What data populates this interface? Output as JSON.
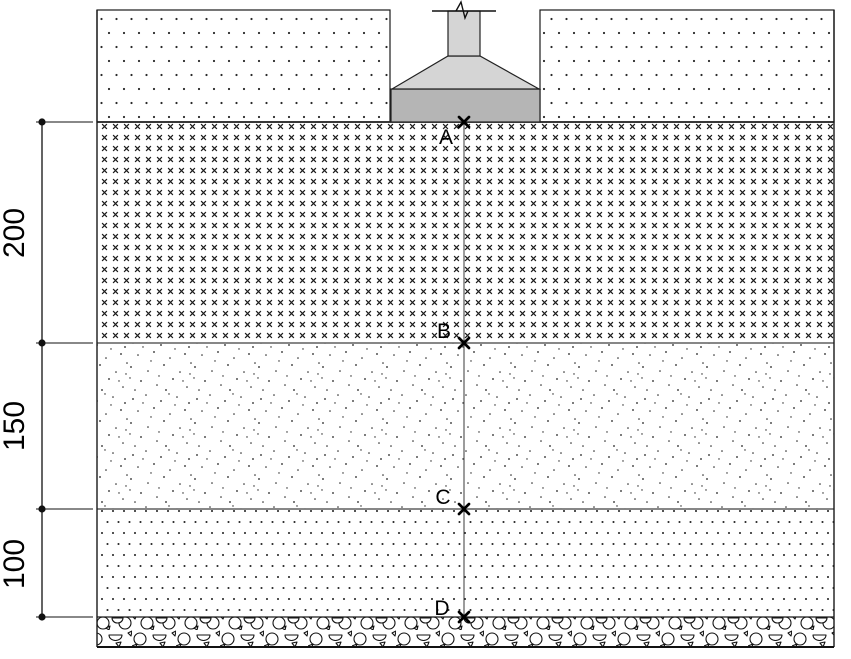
{
  "diagram": {
    "kind": "soil-profile-with-footing",
    "dimension_labels": [
      "200",
      "150",
      "100"
    ],
    "point_labels": [
      "A",
      "B",
      "C",
      "D"
    ],
    "colors": {
      "column_fill": "#d5d5d5",
      "footing_fill": "#b5b5b5",
      "outline": "#1a1a1a",
      "boundary_line": "#767676",
      "measure_line": "#3a3a3a"
    }
  }
}
